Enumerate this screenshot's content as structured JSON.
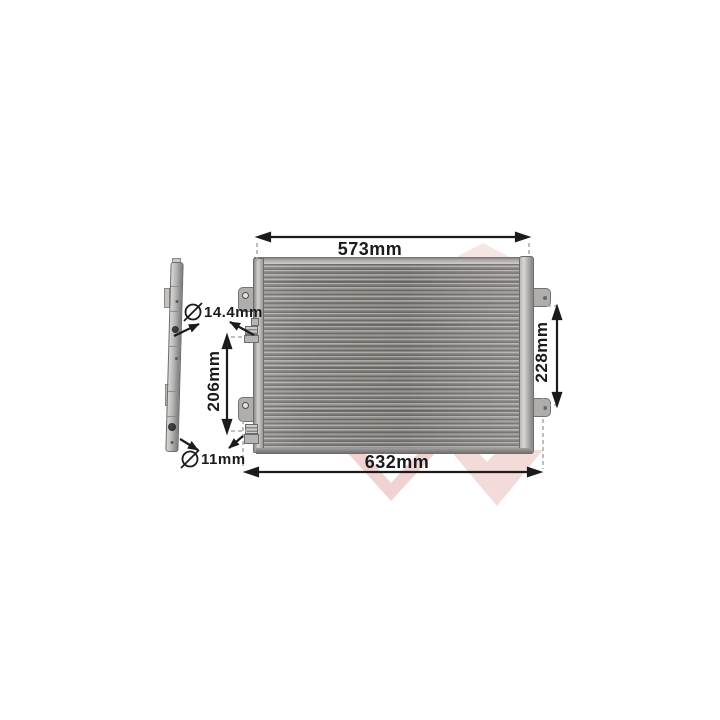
{
  "product_figure": {
    "dimension_labels": {
      "top_width": "573mm",
      "bottom_width": "632mm",
      "right_height": "228mm",
      "left_height": "206mm",
      "upper_port_diameter": "14.4mm",
      "lower_port_diameter": "11mm"
    },
    "icons": {
      "upper_diameter_icon": "diameter-symbol",
      "lower_diameter_icon": "diameter-symbol",
      "diameter_glyph": "⌀"
    },
    "colors": {
      "annotation_black": "#1b1b1b",
      "extension_dash_gray": "#a8a8a8",
      "metal_light": "#d7d5d3",
      "metal_mid": "#b3afac",
      "metal_dark": "#6f6b69",
      "watermark_pink": "#f3dbd9",
      "watermark_pink_light": "#f5e6e4",
      "background": "#ffffff"
    }
  }
}
